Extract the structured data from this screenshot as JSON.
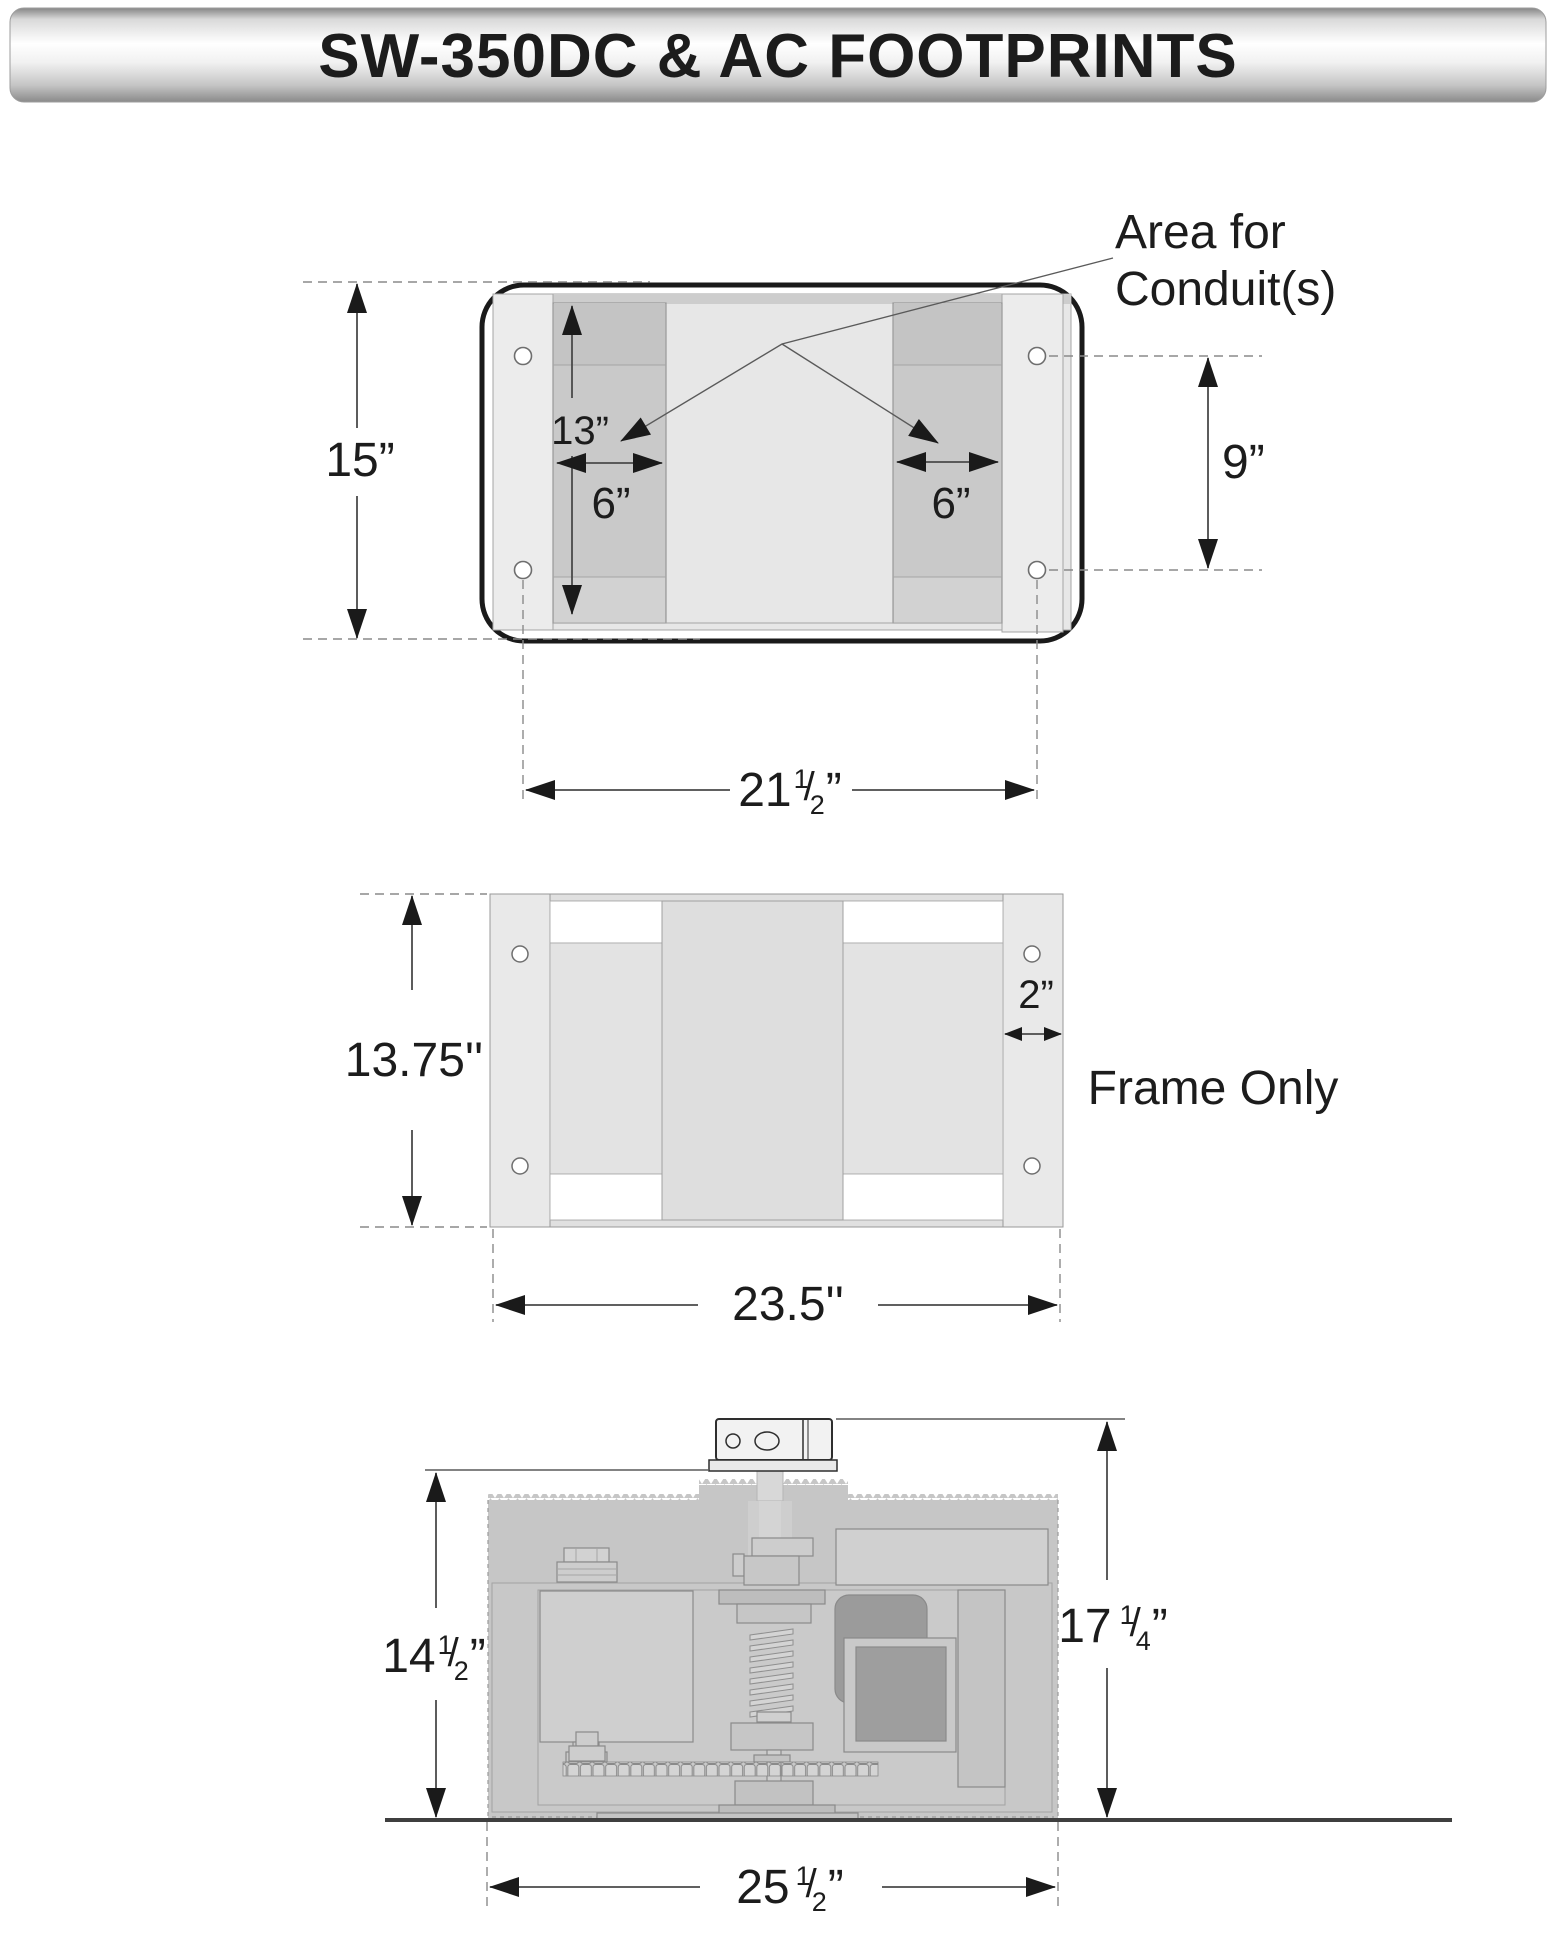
{
  "title": "SW-350DC & AC FOOTPRINTS",
  "top_view": {
    "annotation_line1": "Area for",
    "annotation_line2": "Conduit(s)",
    "dim_height": "15”",
    "dim_conduit_height": "13”",
    "dim_conduit_width_left": "6”",
    "dim_conduit_width_right": "6”",
    "dim_hole_spacing": "9”",
    "dim_width": {
      "whole": "21",
      "num": "1",
      "den": "2",
      "end": "”"
    }
  },
  "frame_view": {
    "label": "Frame Only",
    "dim_height": "13.75''",
    "dim_flange": "2”",
    "dim_width": "23.5''"
  },
  "side_view": {
    "dim_body_height": {
      "whole": "14",
      "num": "1",
      "den": "2",
      "end": "”"
    },
    "dim_total_height": {
      "whole": "17",
      "num": "1",
      "den": "4",
      "end": "”"
    },
    "dim_width": {
      "whole": "25",
      "num": "1",
      "den": "2",
      "end": "”"
    }
  },
  "frac_slash": "/",
  "colors": {
    "line_dark": "#1a1a1a",
    "dimension_line": "#4a4a4a",
    "conduit_band": "#c9c9c9",
    "plate_gray": "#eaeaea",
    "machine_body": "#c6c6c6",
    "dark_component": "#9b9b9b",
    "title_bar_edge": "#8a8a8a",
    "title_bar_center": "#ffffff"
  }
}
